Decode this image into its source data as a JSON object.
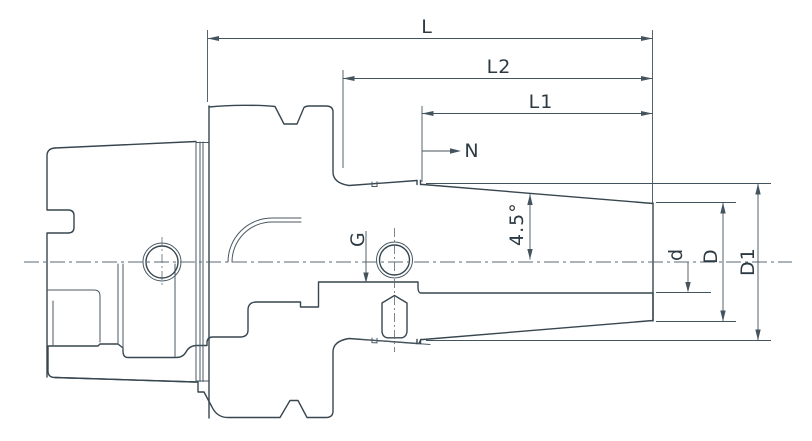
{
  "drawing": {
    "title": "Shrink-fit tool holder technical section drawing",
    "labels": {
      "overall_length": "L",
      "length_l2": "L2",
      "length_l1": "L1",
      "nose_note": "N",
      "coolant_thread": "G",
      "taper_angle": "4.5°",
      "bore_diameter": "d",
      "nose_diameter": "D",
      "big_end_diameter": "D1"
    },
    "colors": {
      "line": "#37464f",
      "dimension_line": "#44545e",
      "hatch": "#85939c",
      "text": "#2c3a44",
      "background": "#ffffff"
    }
  }
}
